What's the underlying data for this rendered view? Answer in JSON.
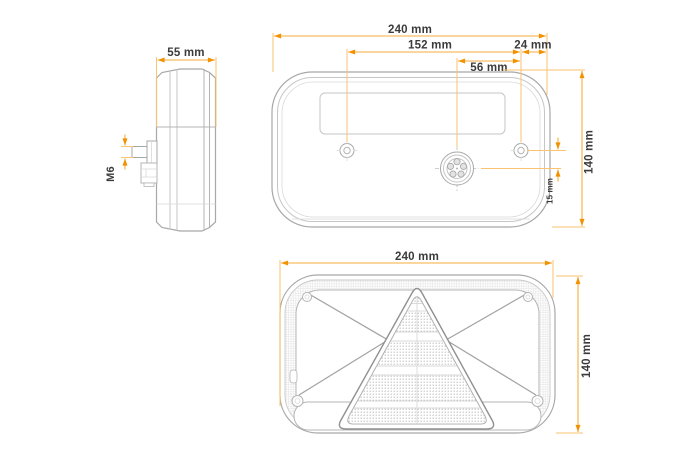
{
  "drawing_kind": "technical-dimension-drawing",
  "colors": {
    "dimension_line": "#F6AC3C",
    "dimension_arrow": "#F29200",
    "extension_line": "#F9C372",
    "outline_gray": "#A8A8A8",
    "detail_gray": "#C6C6C6",
    "label_text": "#3B3B3B",
    "background": "#FFFFFF"
  },
  "side_view": {
    "width_label": "55 mm",
    "bolt_thread_label": "M6"
  },
  "back_view": {
    "width_label": "240 mm",
    "holes_spacing_label": "152 mm",
    "edge_offset_label": "24 mm",
    "connector_spacing_label": "56 mm",
    "height_label": "140 mm",
    "vertical_offset_label": "15 mm"
  },
  "front_view": {
    "width_label": "240 mm",
    "height_label": "140 mm"
  }
}
